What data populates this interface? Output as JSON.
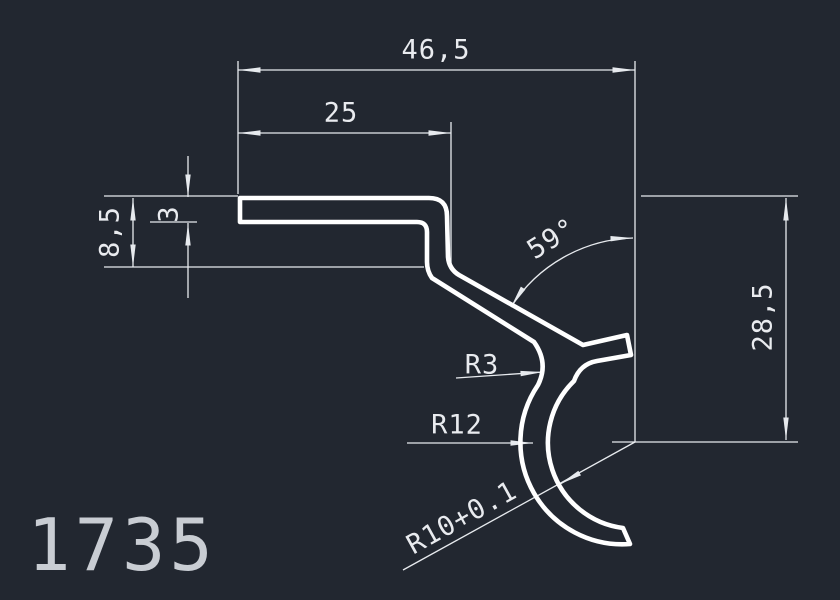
{
  "drawing": {
    "part_number": "1735",
    "dimensions": {
      "total_width": "46,5",
      "flat_width": "25",
      "step_height": "8,5",
      "wall_thickness": "3",
      "bend_angle": "59°",
      "total_height": "28,5",
      "fillet_radius": "R3",
      "outer_radius": "R12",
      "inner_radius": "R10+0.1"
    },
    "colors": {
      "background": "#222730",
      "profile_line": "#ffffff",
      "dimension_line": "#e7eaee",
      "part_number_text": "#c9cdd3"
    }
  }
}
